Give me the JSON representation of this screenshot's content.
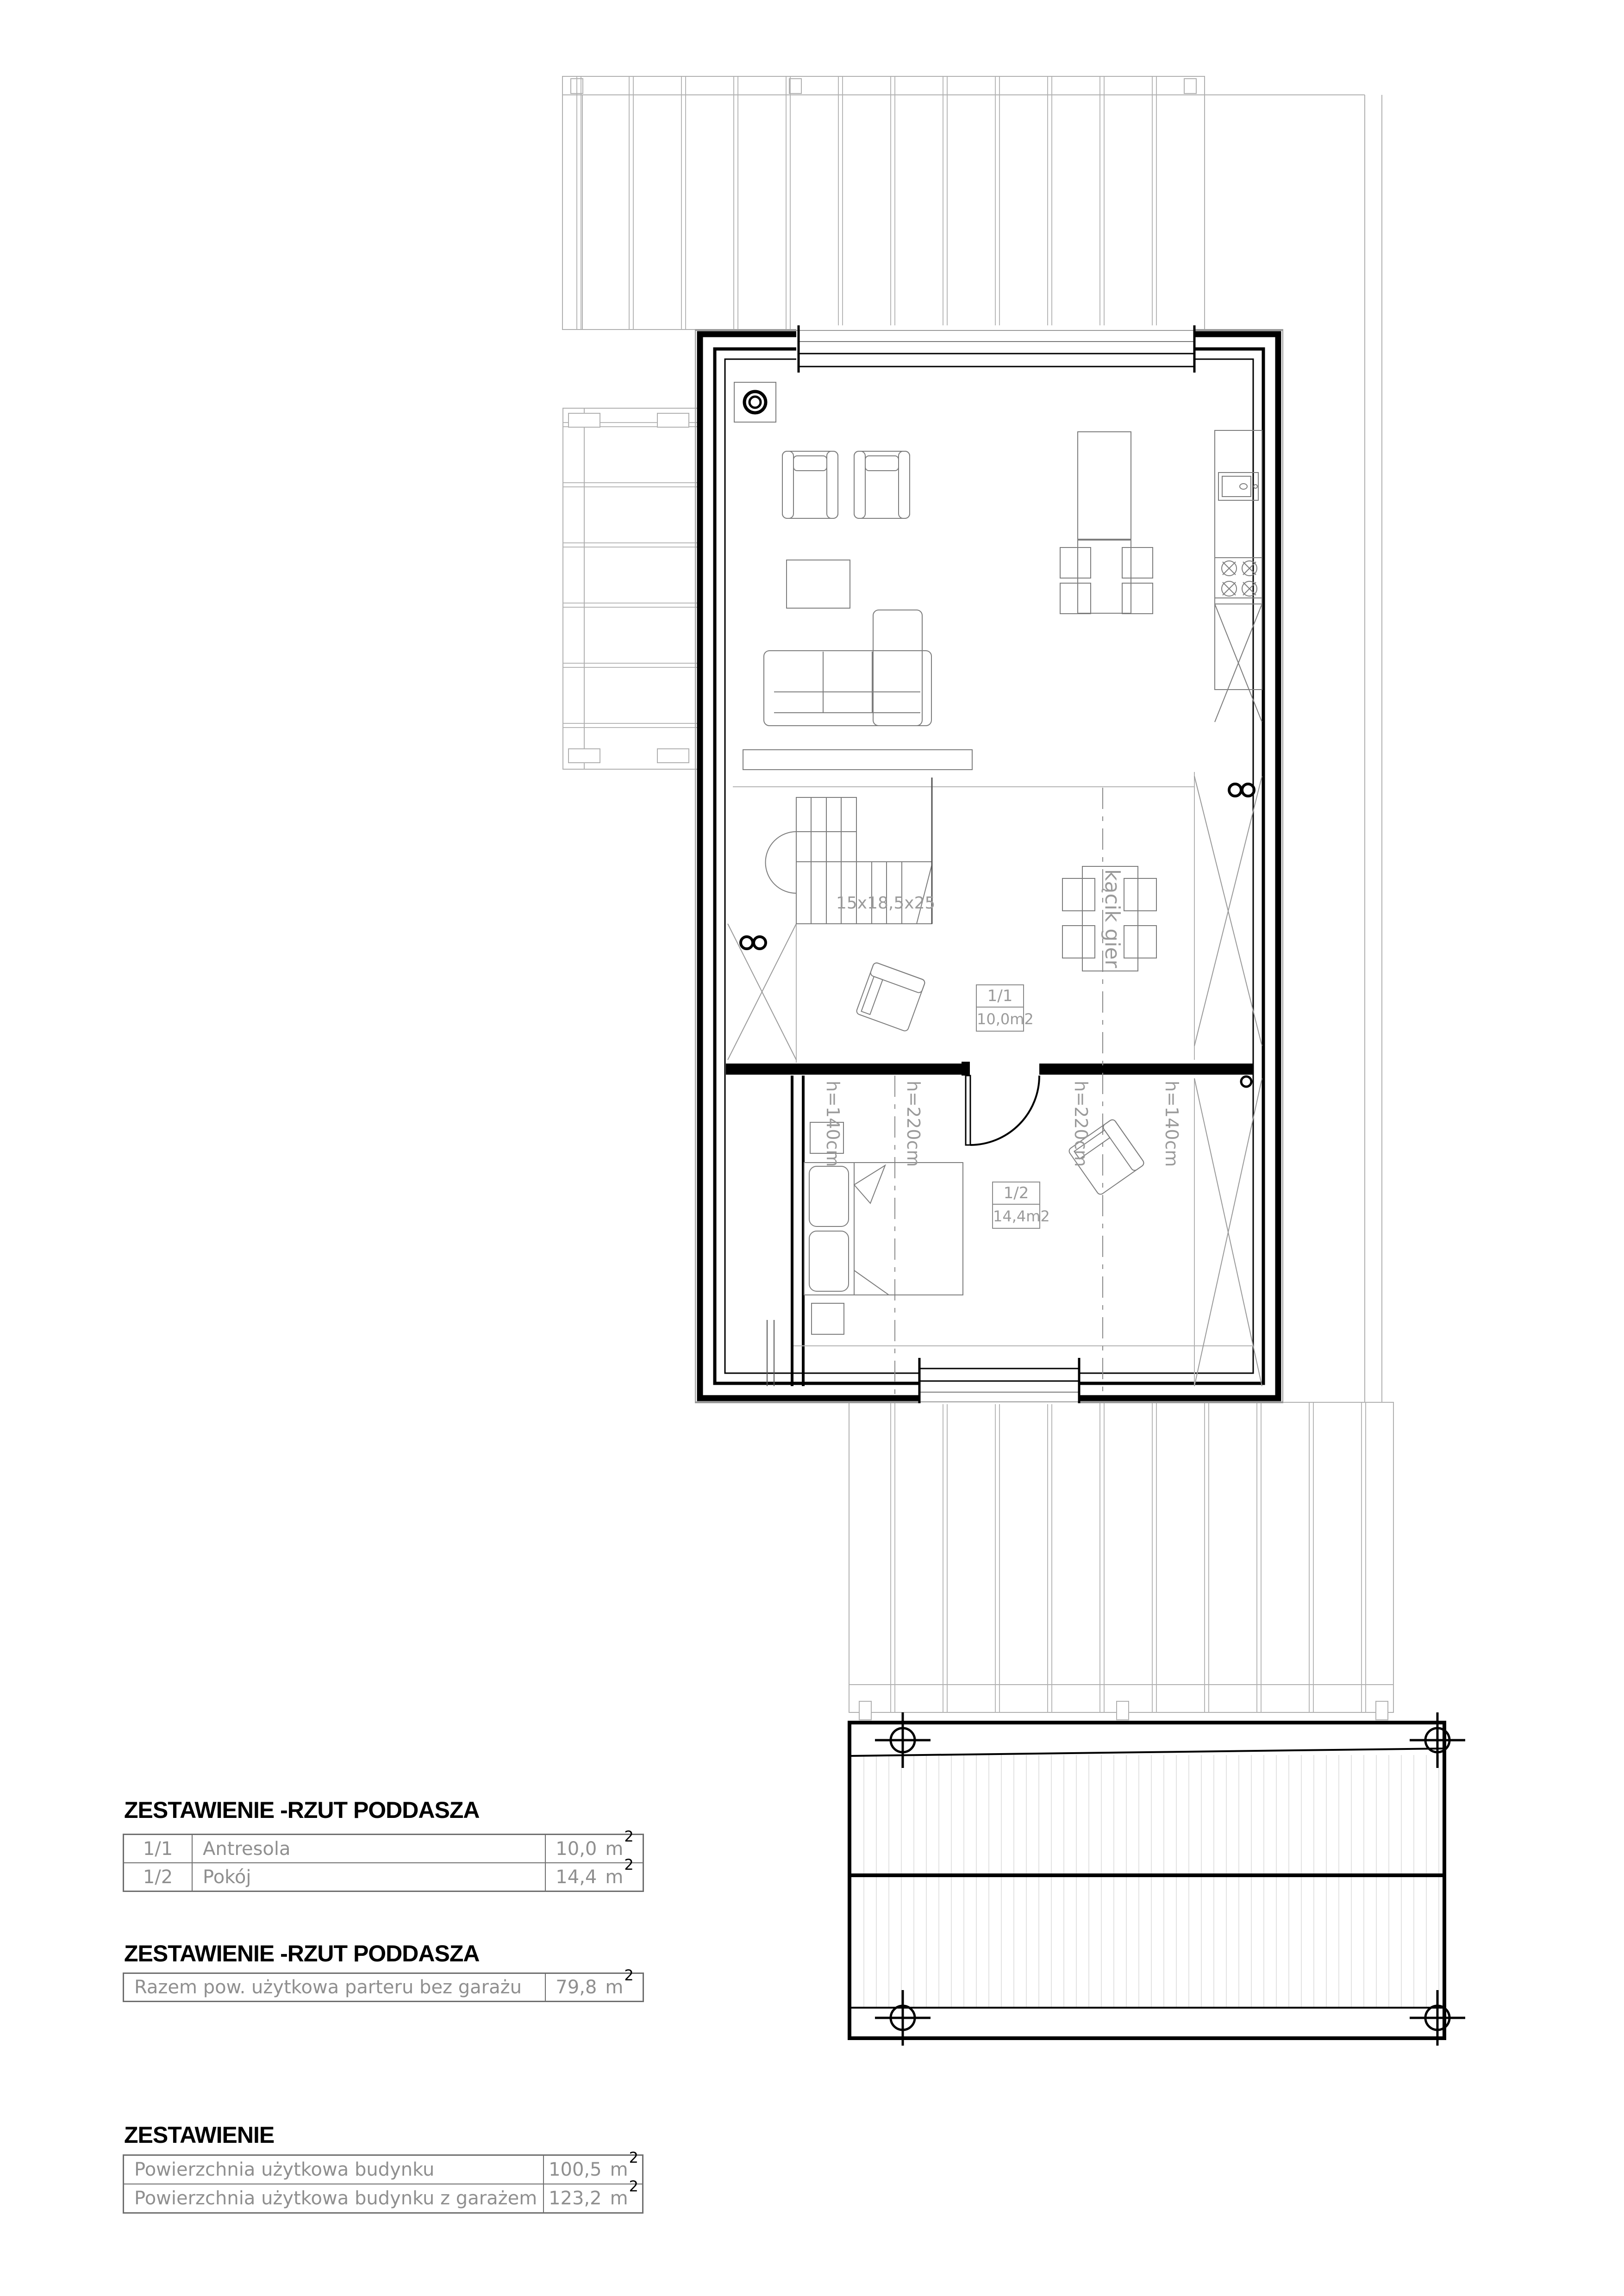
{
  "colors": {
    "wall": "#000000",
    "roof_line": "#b0b0b0",
    "furniture_line": "#7d7d7d",
    "annotation_text": "#9a9a9a",
    "table_text": "#8f8f8f",
    "table_border": "#6e6e6e",
    "hatch": "#e0e0e0"
  },
  "plan": {
    "room_tags": [
      {
        "number": "1/1",
        "area": "10,0m2"
      },
      {
        "number": "1/2",
        "area": "14,4m2"
      }
    ],
    "annotations": {
      "stair_steps": "15x18,5x25",
      "game_corner": "kącik gier",
      "height_left_knee": "h=140cm",
      "height_left_mid": "h=220cm",
      "height_right_mid": "h=220cm",
      "height_right_knee": "h=140cm"
    }
  },
  "tables": [
    {
      "title": "ZESTAWIENIE -RZUT PODDASZA",
      "rows": [
        {
          "no": "1/1",
          "name": "Antresola",
          "value": "10,0"
        },
        {
          "no": "1/2",
          "name": "Pokój",
          "value": "14,4"
        }
      ]
    },
    {
      "title": "ZESTAWIENIE -RZUT PODDASZA",
      "rows": [
        {
          "name": "Razem pow. użytkowa parteru bez garażu",
          "value": "79,8"
        }
      ]
    },
    {
      "title": "ZESTAWIENIE",
      "rows": [
        {
          "name": "Powierzchnia użytkowa budynku",
          "value": "100,5"
        },
        {
          "name": "Powierzchnia użytkowa budynku z garażem",
          "value": "123,2"
        }
      ]
    }
  ],
  "units": {
    "base": "m",
    "sup": "2"
  }
}
